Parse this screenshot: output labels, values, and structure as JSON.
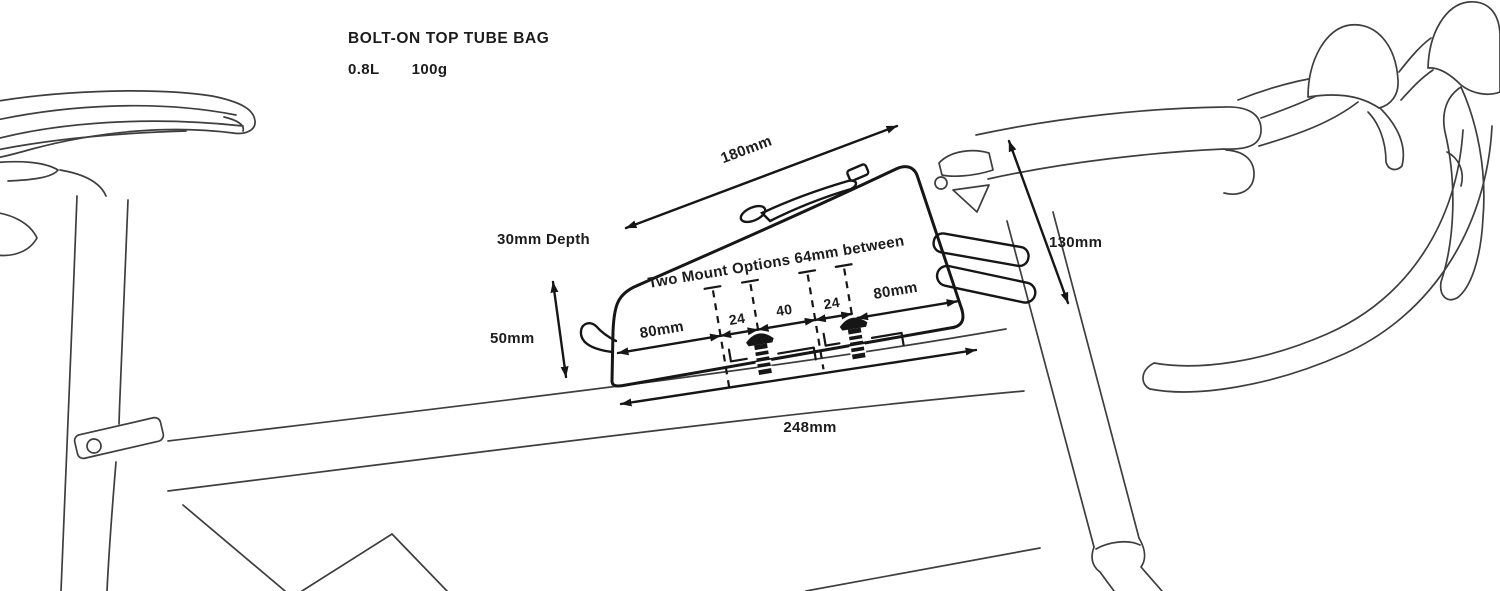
{
  "header": {
    "title": "BOLT-ON TOP TUBE BAG",
    "volume": "0.8L",
    "weight": "100g"
  },
  "diagram": {
    "annotation": "Two Mount Options 64mm between",
    "dims": {
      "top_length": "180mm",
      "depth": "30mm Depth",
      "height": "50mm",
      "front_height": "130mm",
      "base_length": "248mm",
      "rear_offset": "80mm",
      "front_offset": "80mm",
      "gap_rear": "24",
      "gap_center": "40",
      "gap_front": "24"
    },
    "colors": {
      "ink": "#161616",
      "line_art": "#3e3e3e",
      "background": "#ffffff"
    }
  }
}
